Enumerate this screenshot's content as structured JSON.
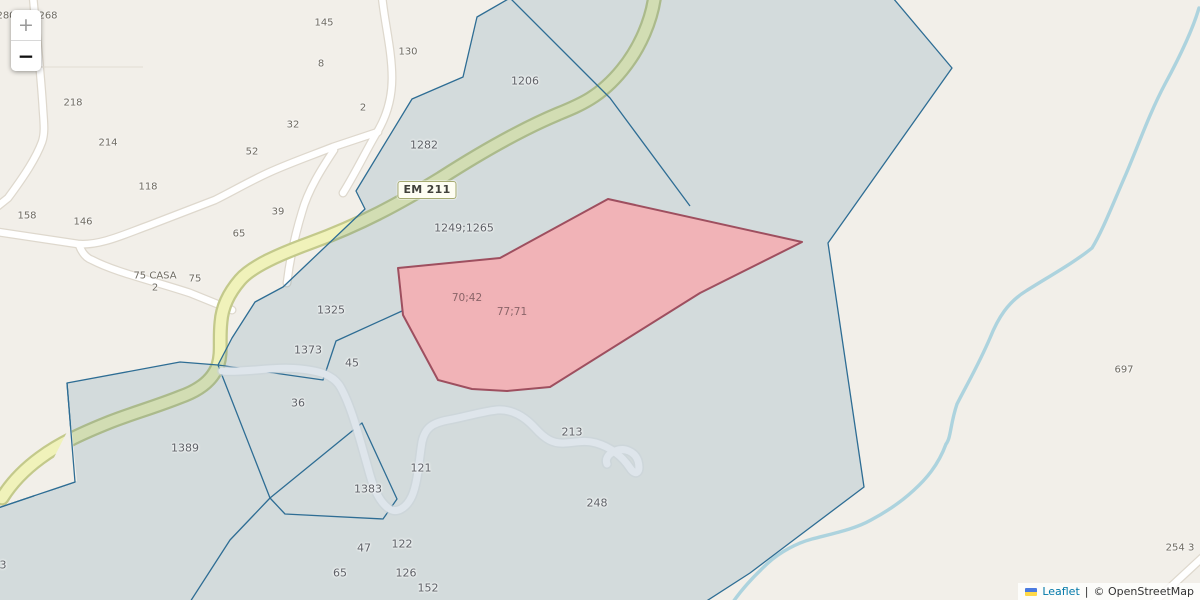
{
  "map": {
    "road_ref": "EM 211",
    "labels": [
      {
        "text": "280",
        "x": 6,
        "y": 16,
        "kind": "house"
      },
      {
        "text": "268",
        "x": 48,
        "y": 16,
        "kind": "house"
      },
      {
        "text": "145",
        "x": 324,
        "y": 23,
        "kind": "house"
      },
      {
        "text": "130",
        "x": 408,
        "y": 52,
        "kind": "house"
      },
      {
        "text": "8",
        "x": 321,
        "y": 64,
        "kind": "house"
      },
      {
        "text": "2",
        "x": 363,
        "y": 108,
        "kind": "house"
      },
      {
        "text": "32",
        "x": 293,
        "y": 125,
        "kind": "house"
      },
      {
        "text": "52",
        "x": 252,
        "y": 152,
        "kind": "house"
      },
      {
        "text": "218",
        "x": 73,
        "y": 103,
        "kind": "house"
      },
      {
        "text": "214",
        "x": 108,
        "y": 143,
        "kind": "house"
      },
      {
        "text": "118",
        "x": 148,
        "y": 187,
        "kind": "house"
      },
      {
        "text": "158",
        "x": 27,
        "y": 216,
        "kind": "house"
      },
      {
        "text": "146",
        "x": 83,
        "y": 222,
        "kind": "house"
      },
      {
        "text": "39",
        "x": 278,
        "y": 212,
        "kind": "house"
      },
      {
        "text": "65",
        "x": 239,
        "y": 234,
        "kind": "house"
      },
      {
        "text": "75 CASA",
        "x": 155,
        "y": 276,
        "kind": "house"
      },
      {
        "text": "2",
        "x": 155,
        "y": 288,
        "kind": "house"
      },
      {
        "text": "75",
        "x": 195,
        "y": 279,
        "kind": "house"
      },
      {
        "text": "697",
        "x": 1124,
        "y": 370,
        "kind": "house"
      },
      {
        "text": "254 3",
        "x": 1180,
        "y": 548,
        "kind": "house"
      },
      {
        "text": "1206",
        "x": 525,
        "y": 81,
        "kind": "parcel"
      },
      {
        "text": "1282",
        "x": 424,
        "y": 145,
        "kind": "parcel"
      },
      {
        "text": "1249;1265",
        "x": 464,
        "y": 228,
        "kind": "parcel"
      },
      {
        "text": "1325",
        "x": 331,
        "y": 310,
        "kind": "parcel"
      },
      {
        "text": "1373",
        "x": 308,
        "y": 350,
        "kind": "parcel"
      },
      {
        "text": "45",
        "x": 352,
        "y": 363,
        "kind": "parcel"
      },
      {
        "text": "36",
        "x": 298,
        "y": 403,
        "kind": "parcel"
      },
      {
        "text": "1389",
        "x": 185,
        "y": 448,
        "kind": "parcel"
      },
      {
        "text": "1383",
        "x": 368,
        "y": 489,
        "kind": "parcel"
      },
      {
        "text": "121",
        "x": 421,
        "y": 468,
        "kind": "parcel"
      },
      {
        "text": "213",
        "x": 572,
        "y": 432,
        "kind": "parcel"
      },
      {
        "text": "248",
        "x": 597,
        "y": 503,
        "kind": "parcel"
      },
      {
        "text": "47",
        "x": 364,
        "y": 548,
        "kind": "parcel"
      },
      {
        "text": "122",
        "x": 402,
        "y": 544,
        "kind": "parcel"
      },
      {
        "text": "65",
        "x": 340,
        "y": 573,
        "kind": "parcel"
      },
      {
        "text": "126",
        "x": 406,
        "y": 573,
        "kind": "parcel"
      },
      {
        "text": "152",
        "x": 428,
        "y": 588,
        "kind": "parcel"
      },
      {
        "text": "3",
        "x": 3,
        "y": 565,
        "kind": "parcel"
      },
      {
        "text": "70;42",
        "x": 467,
        "y": 298,
        "kind": "red"
      },
      {
        "text": "77;71",
        "x": 512,
        "y": 312,
        "kind": "red"
      }
    ]
  },
  "zoom_control": {
    "zoom_in": "+",
    "zoom_out": "−"
  },
  "attribution": {
    "flag": "ukraine-flag",
    "leaflet": "Leaflet",
    "separator": "|",
    "copyright": "© OpenStreetMap"
  },
  "colors": {
    "bg": "#f2efe9",
    "accent": "#2e6d94",
    "parcel_fill": "rgba(31,99,145,0.14)",
    "highlight_fill": "#f1b3b7",
    "highlight_stroke": "#9e4f5f",
    "road_yellow": "#f0f2ba",
    "road_yellow_casing": "#c3c98b",
    "stream": "#a7d0dc",
    "leaflet_link": "#0078a8"
  }
}
